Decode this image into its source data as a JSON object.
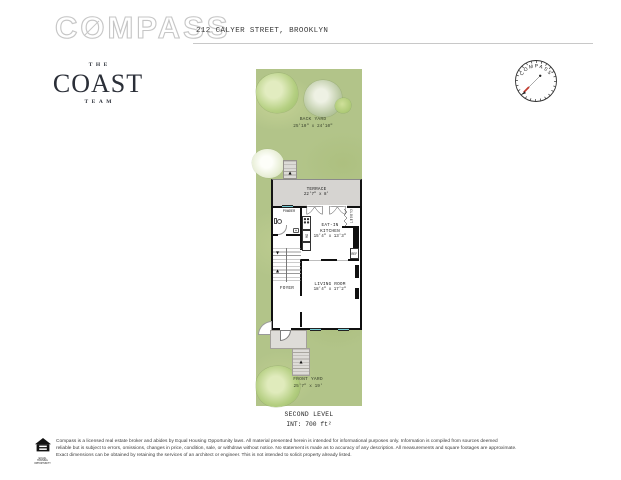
{
  "header": {
    "logo_text": "COMPASS",
    "address": "212 CALYER STREET, BROOKLYN"
  },
  "branding": {
    "team_top": "THE",
    "team_name": "COAST",
    "team_bottom": "TEAM",
    "compass_rose_label": "COMPASS"
  },
  "plan": {
    "back_yard": {
      "label": "BACK YARD",
      "dims": "25'10\" x 24'10\""
    },
    "terrace": {
      "label": "TERRACE",
      "dims": "22'7\" x 8'"
    },
    "powder": {
      "label": "POWDER"
    },
    "kitchen": {
      "line1": "EAT-IN",
      "line2": "KITCHEN",
      "dims": "15'4\" x 13'3\""
    },
    "closet": {
      "label": "CLOSET"
    },
    "refrigerator": {
      "label": "REF"
    },
    "dishwasher": {
      "label": "DW"
    },
    "foyer": {
      "label": "FOYER"
    },
    "living_room": {
      "label": "LIVING ROOM",
      "dims": "18'4\" x 17'2\""
    },
    "front_yard": {
      "label": "FRONT YARD",
      "dims": "25'7\" x 19'"
    },
    "level": "SECOND LEVEL",
    "interior_area": "INT: 700 ft²"
  },
  "icons": {
    "up_arrow": "▲",
    "down_arrow": "▼"
  },
  "colors": {
    "yard_green": "#b2c489",
    "terrace_gray": "#d6d4d1",
    "wall_black": "#101010",
    "window_teal": "#74ccd6",
    "needle_red": "#c23b2e"
  },
  "footer": {
    "equal_housing_caption": "EQUAL HOUSING OPPORTUNITY",
    "line1": "Compass is a licensed real estate broker and abides by Equal Housing Opportunity laws. All material presented herein is intended for informational purposes only. Information is compiled from sources deemed",
    "line2": "reliable but is subject to errors, omissions, changes in price, condition, sale, or withdraw without notice. No statement is made as to accuracy of any description. All measurements and square footages are approximate.",
    "line3": "Exact dimensions can be obtained by retaining the services of an architect or engineer. This is not intended to solicit property already listed."
  }
}
